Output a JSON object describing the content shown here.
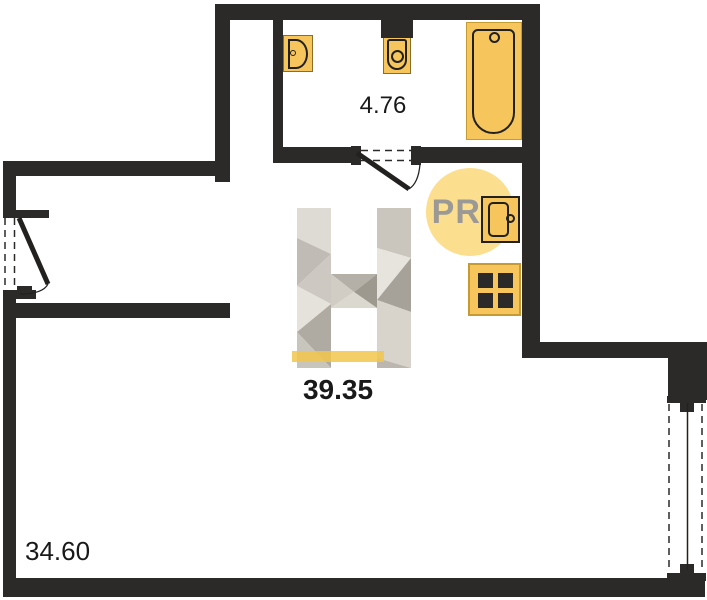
{
  "floorplan": {
    "labels": {
      "bathroom_area": "4.76",
      "total_area": "39.35",
      "living_area": "34.60"
    },
    "badge": {
      "text": "PRO"
    },
    "fixtures": [
      "washbasin-icon",
      "toilet-icon",
      "bathtub-icon",
      "kitchen-sink-icon",
      "stove-icon",
      "entry-door-icon",
      "bathroom-door-icon",
      "window-icon"
    ],
    "colors": {
      "wall": "#2b2a28",
      "fixture_fill": "#f6c55c",
      "fixture_stroke": "#22211f",
      "badge_fill": "#fbde8e",
      "badge_text": "#9b9995",
      "label_text": "#191919",
      "watermark_bar": "#f2c64b",
      "watermark_facets": [
        "#e9e6e0",
        "#ddd9d2",
        "#cbc7bf",
        "#bdb8b0",
        "#aba69e",
        "#989489"
      ]
    }
  }
}
